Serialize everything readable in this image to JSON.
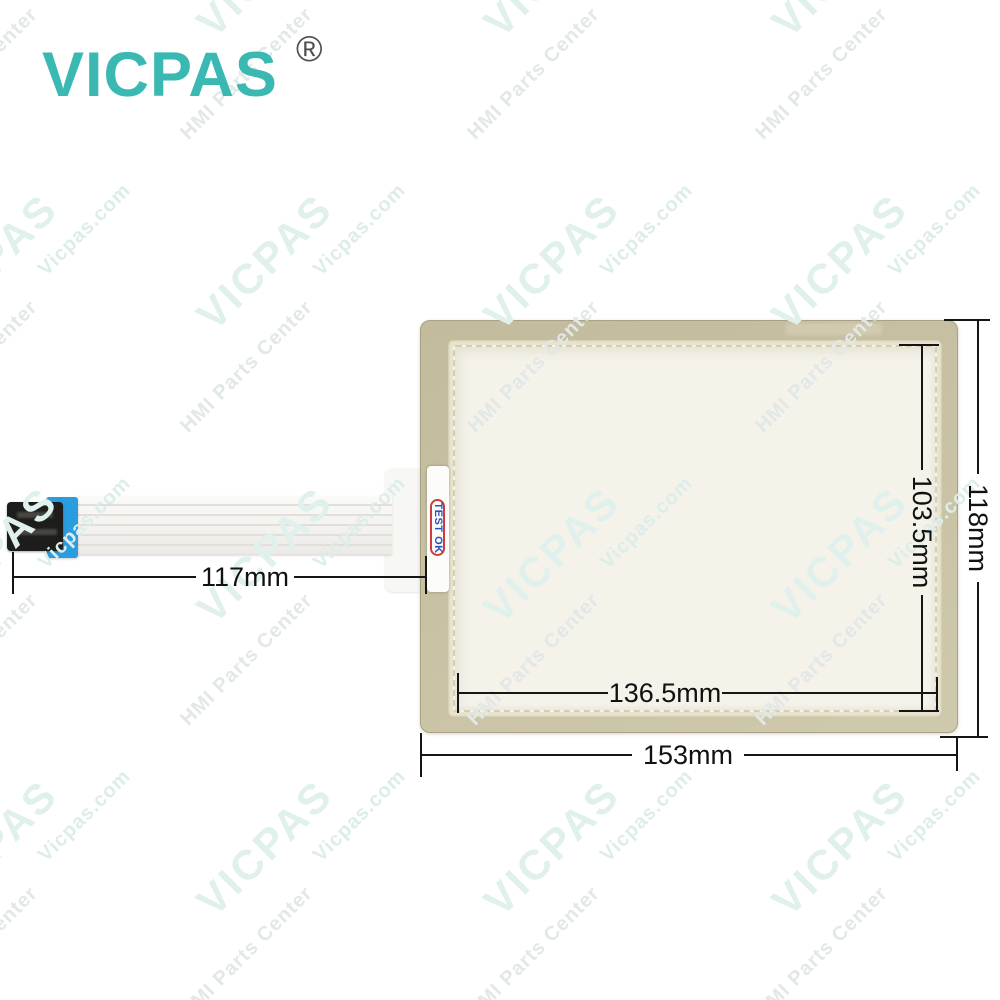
{
  "brand": {
    "name": "VICPAS",
    "registered_mark": "®",
    "logo_color": "#3ab8b2"
  },
  "watermark": {
    "brand": "VICPAS",
    "site": "Vicpas.com",
    "tagline": "HMI Parts Center",
    "brand_color": "#e0f0ed",
    "site_color": "#dcedea",
    "tagline_color": "#e2e7e7"
  },
  "panel": {
    "test_label": "TEST OK",
    "label_text_color": "#2b50c0",
    "label_ring_color": "#cf3a3a",
    "bezel_color": "#c8c1a3",
    "active_area_color": "#f4f2e9",
    "connector_blue": "#2a9de0",
    "connector_black": "#1d1d1b"
  },
  "dimensions": {
    "cable_length": "117mm",
    "active_area_width": "136.5mm",
    "active_area_height": "103.5mm",
    "panel_width": "153mm",
    "panel_height": "118mm",
    "line_color": "#151515"
  }
}
